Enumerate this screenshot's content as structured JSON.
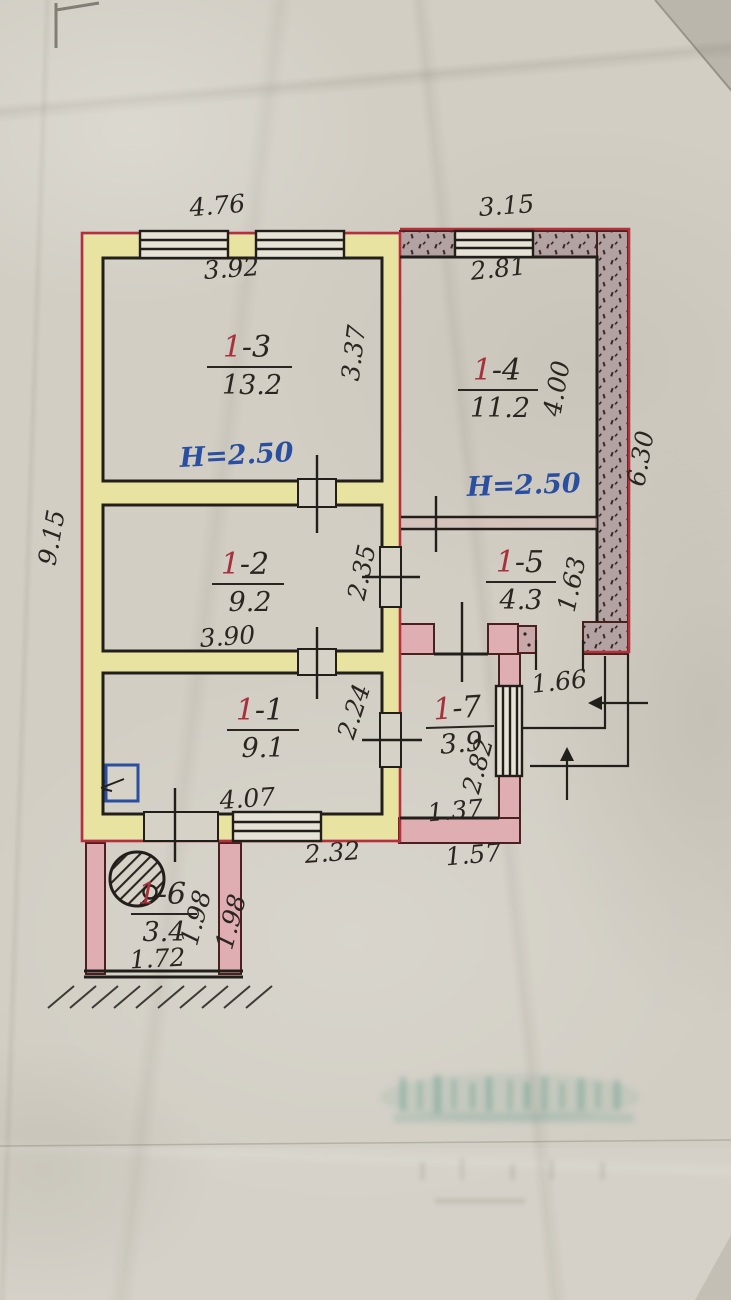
{
  "document": {
    "kind": "hand-drawn apartment floor plan photo",
    "colors": {
      "paper": "#d2cec4",
      "outline_red": "#b5303a",
      "wall_yellow": "#e9e3a2",
      "wall_pink": "#dfaeb2",
      "wall_stippled": "#b3a2a2",
      "ink_black": "#2a2520",
      "ink_blue": "#2b4fa0",
      "room_number_red": "#a8303c",
      "stamp_green": "#4f9180"
    }
  },
  "rooms": [
    {
      "num_red": "1",
      "num_rest": "-3",
      "area": "13.2"
    },
    {
      "num_red": "1",
      "num_rest": "-4",
      "area": "11.2"
    },
    {
      "num_red": "1",
      "num_rest": "-2",
      "area": "9.2"
    },
    {
      "num_red": "1",
      "num_rest": "-5",
      "area": "4.3"
    },
    {
      "num_red": "1",
      "num_rest": "-1",
      "area": "9.1"
    },
    {
      "num_red": "1",
      "num_rest": "-7",
      "area": "3.9"
    },
    {
      "num_red": "1",
      "num_rest": "-6",
      "area": "3.4"
    }
  ],
  "heights": {
    "left": "H=2.50",
    "right": "H=2.50"
  },
  "dims": {
    "d476": "4.76",
    "d392": "3.92",
    "d337": "3.37",
    "d315": "3.15",
    "d281": "2.81",
    "d400": "4.00",
    "d630": "6.30",
    "d915": "9.15",
    "d235": "2.35",
    "d390": "3.90",
    "d163": "1.63",
    "d166": "1.66",
    "d224": "2.24",
    "d407": "4.07",
    "d282": "2.82",
    "d137": "1.37",
    "d232": "2.32",
    "d157": "1.57",
    "d198a": "1.98",
    "d198b": "1.98",
    "d172": "1.72"
  }
}
